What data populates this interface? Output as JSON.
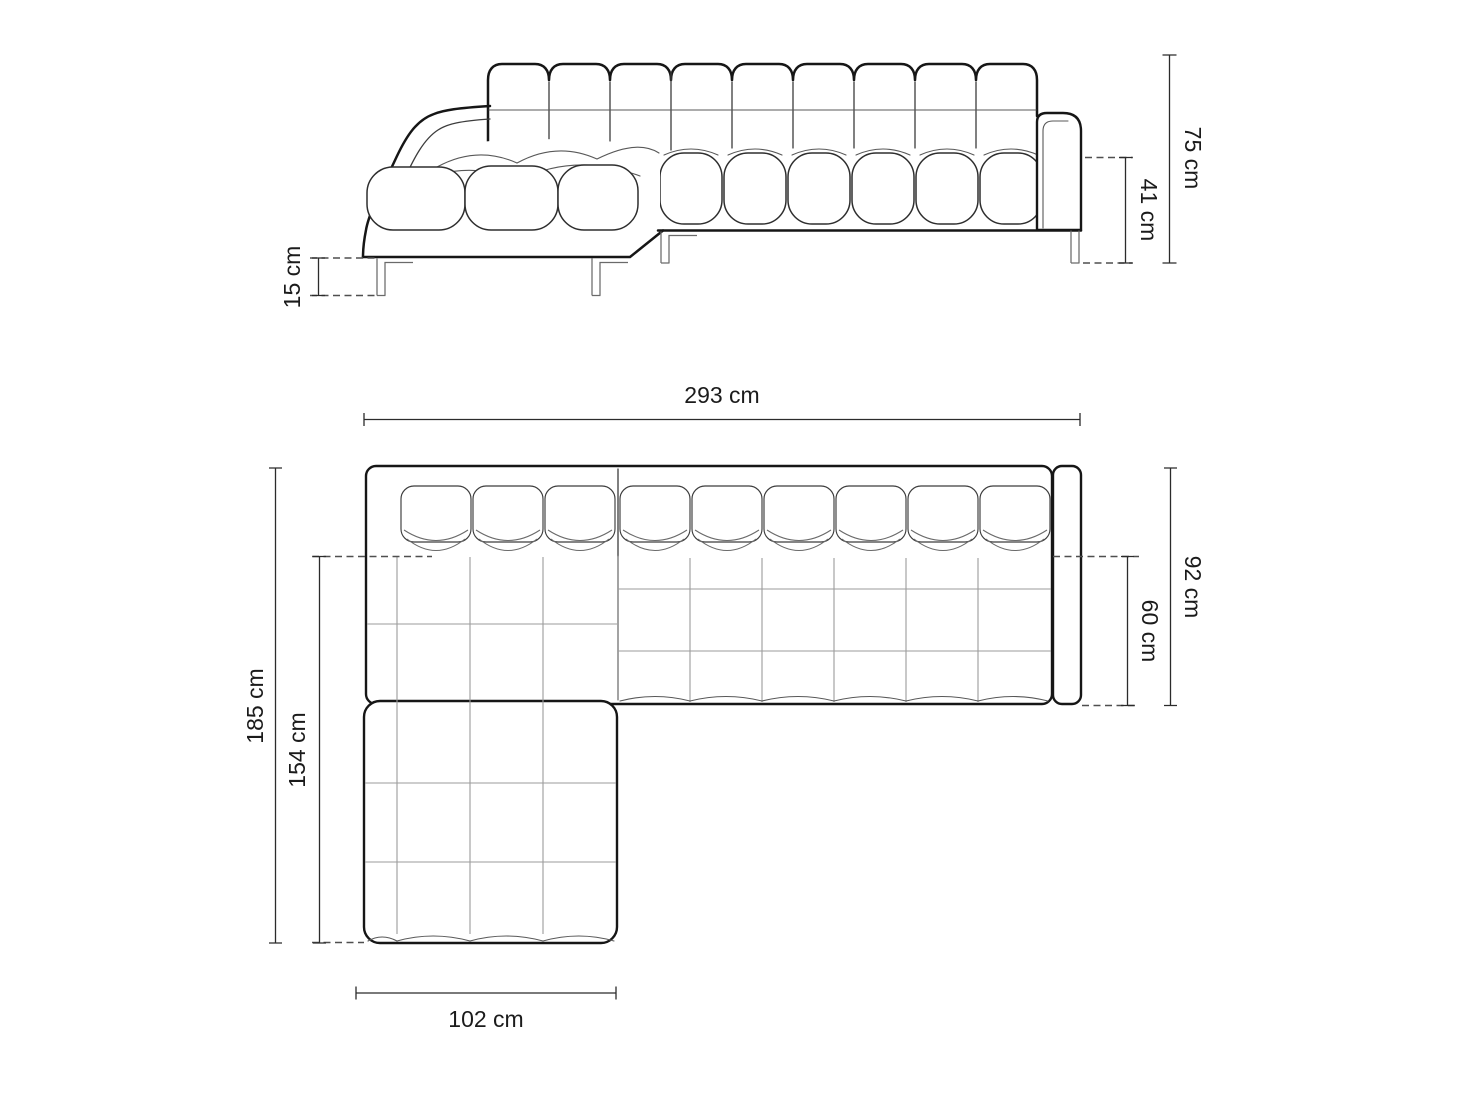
{
  "diagram": {
    "side_view": {
      "total_height": "75 cm",
      "seat_height": "41 cm",
      "leg_height": "15 cm"
    },
    "plan_view": {
      "total_width": "293 cm",
      "total_depth": "92 cm",
      "seat_depth": "60 cm",
      "chaise_length": "185 cm",
      "chaise_seat_length": "154 cm",
      "chaise_width": "102 cm"
    },
    "colors": {
      "background": "#ffffff",
      "outline": "#161616",
      "detail_line": "#3c3c3c",
      "grid_line": "#9b9b9b",
      "dimension_line": "#2b2b2b",
      "label_text": "#1b1b1b"
    }
  }
}
